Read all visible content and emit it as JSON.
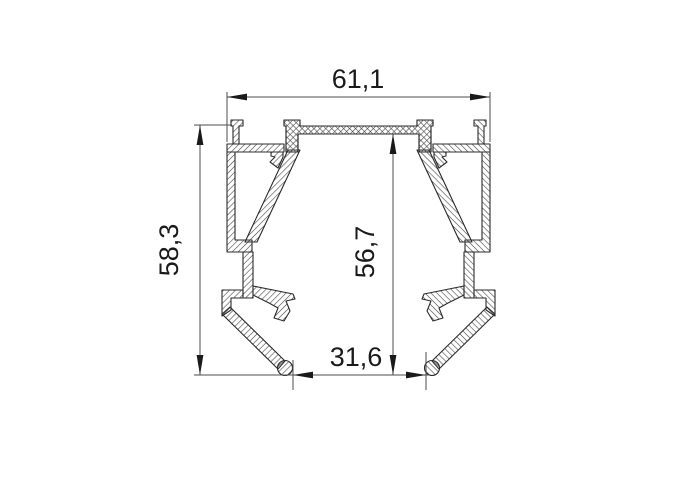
{
  "drawing": {
    "dimensions": {
      "overall_width": {
        "label": "61,1"
      },
      "overall_height": {
        "label": "58,3"
      },
      "inner_height": {
        "label": "56,7"
      },
      "bottom_opening": {
        "label": "31,6"
      }
    },
    "colors": {
      "background": "#ffffff",
      "profile_line": "#2b2b2b",
      "hatch_line": "#444444",
      "dimension_line": "#4d4d4d",
      "text": "#1a1a1a"
    }
  }
}
